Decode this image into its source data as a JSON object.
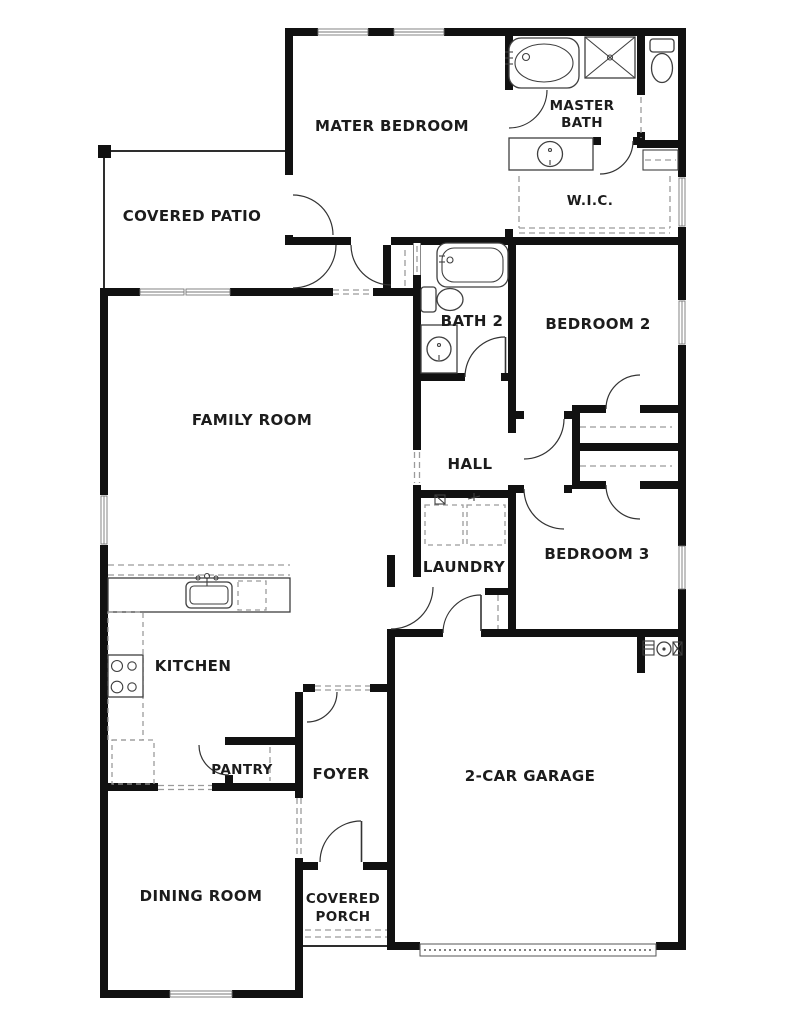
{
  "plan": {
    "title": "single-story house floor plan",
    "rooms": {
      "master_bedroom": {
        "label": "MATER BEDROOM"
      },
      "master_bath": {
        "label_line1": "MASTER",
        "label_line2": "BATH"
      },
      "wic": {
        "label": "W.I.C."
      },
      "covered_patio": {
        "label": "COVERED PATIO"
      },
      "bath2": {
        "label": "BATH 2"
      },
      "bedroom2": {
        "label": "BEDROOM 2"
      },
      "family_room": {
        "label": "FAMILY ROOM"
      },
      "hall": {
        "label": "HALL"
      },
      "laundry": {
        "label": "LAUNDRY"
      },
      "bedroom3": {
        "label": "BEDROOM 3"
      },
      "kitchen": {
        "label": "KITCHEN"
      },
      "pantry": {
        "label": "PANTRY"
      },
      "foyer": {
        "label": "FOYER"
      },
      "garage": {
        "label": "2-CAR GARAGE"
      },
      "dining_room": {
        "label": "DINING ROOM"
      },
      "covered_porch": {
        "label_line1": "COVERED",
        "label_line2": "PORCH"
      }
    },
    "fixtures": {
      "master_bath": [
        "bathtub",
        "shower",
        "toilet",
        "vanity-sink"
      ],
      "bath2": [
        "bathtub",
        "toilet",
        "vanity-sink"
      ],
      "kitchen": [
        "island-sink",
        "dishwasher",
        "range",
        "refrigerator"
      ],
      "laundry": [
        "washer",
        "dryer"
      ],
      "garage": [
        "water-heater"
      ],
      "doors": "swing-arc",
      "garage_door": "dotted-panel"
    },
    "colors": {
      "background": "#ffffff",
      "wall": "#111111",
      "fixture_line": "#3f3f3f",
      "dash_line": "#9b9b9b",
      "label_text": "#1c1c1c"
    }
  }
}
